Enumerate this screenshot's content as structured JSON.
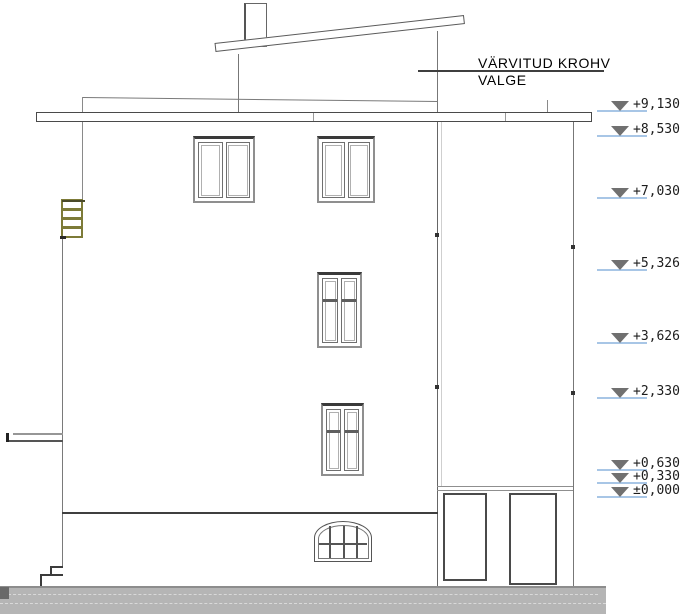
{
  "annotation": {
    "material": {
      "line1": "VÄRVITUD KROHV",
      "line2": "VALGE"
    }
  },
  "levels": {
    "items": [
      {
        "label": "+9,130"
      },
      {
        "label": "+8,530"
      },
      {
        "label": "+7,030"
      },
      {
        "label": "+5,326"
      },
      {
        "label": "+3,626"
      },
      {
        "label": "+2,330"
      },
      {
        "label": "+0,630"
      },
      {
        "label": "+0,330"
      },
      {
        "label": "±0,000"
      }
    ]
  },
  "colors": {
    "outline": "#777777",
    "dark_line": "#3f3f3f",
    "level_blue": "#a8c6e6",
    "marker_gray": "#707070",
    "ground_gray": "#b5b5b5",
    "ladder_olive": "#7d7b38"
  }
}
